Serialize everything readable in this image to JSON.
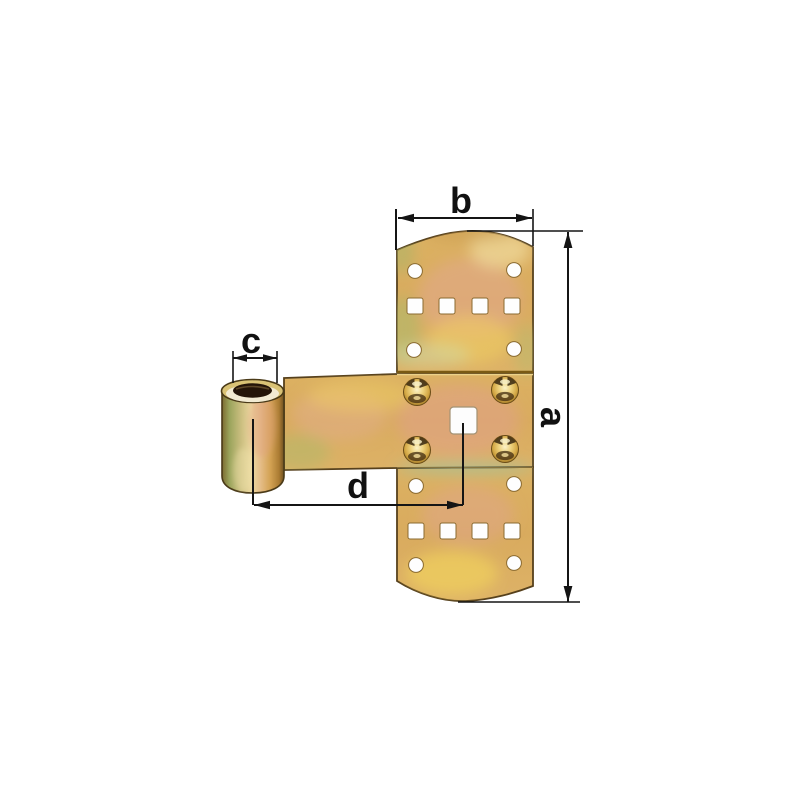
{
  "figure": {
    "kind": "annotated product dimension drawing of a T-shaped cross hinge with pivot sleeve",
    "background": "#ffffff"
  },
  "dimension_labels": {
    "a": "a",
    "b": "b",
    "c": "c",
    "d": "d"
  },
  "colors": {
    "dimension_line": "#151515",
    "metal_gold": "#d9ae5e",
    "metal_pink": "#e2a88e",
    "metal_green": "#aeb96a",
    "metal_pale_highlight": "#f3e3a8",
    "metal_outline": "#56401c",
    "seam_dark": "#7a5a14",
    "bore_dark": "#241408",
    "hole_white": "#fefefe"
  }
}
